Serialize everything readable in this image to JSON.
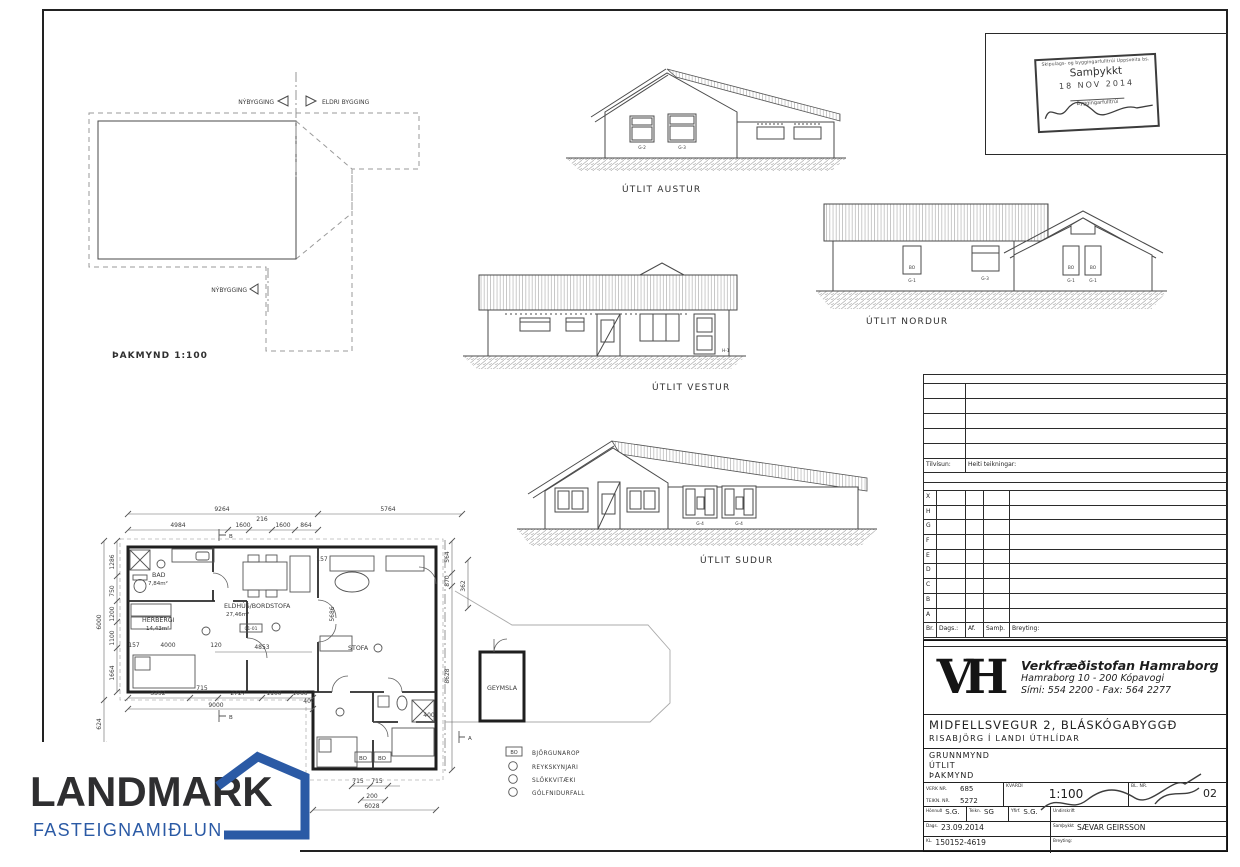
{
  "page": {
    "bg": "#ffffff",
    "line_color": "#3c3c3c",
    "accent_blue": "#2b5aa5"
  },
  "stamp": {
    "line1": "Skipulags- og byggingarfulltrúi Uppsveita bs.",
    "line2": "Samþykkt",
    "date": "18 NOV 2014",
    "line4": "Byggingarfulltrúi"
  },
  "roof_plan": {
    "title": "ÞAKMYND 1:100",
    "new_label": "NÝBYGGING",
    "old_label": "ELDRI BYGGING",
    "new_label2": "NÝBYGGING"
  },
  "elevations": {
    "east": "ÚTLIT AUSTUR",
    "west": "ÚTLIT VESTUR",
    "north": "ÚTLIT NORDUR",
    "south": "ÚTLIT SUDUR",
    "tags": {
      "g1": "G-1",
      "g2": "G-2",
      "g3": "G-3",
      "g4": "G-4",
      "bo": "BO",
      "h1": "H-1"
    }
  },
  "floor_plan": {
    "rooms": {
      "bad": "BAD",
      "bad_area": "7,84m²",
      "herbergi": "HERBERGI",
      "herbergi_area": "14,43m²",
      "eldhus": "ELDHÚS/BORDSTOFA",
      "eldhus_area": "27,46m²",
      "stofa": "STOFA",
      "geymsla": "GEYMSLA"
    },
    "ref": "01-01",
    "bo": "BO",
    "sections": {
      "a": "A",
      "b": "B"
    },
    "dims": {
      "d9264": "9264",
      "d5764": "5764",
      "d4984": "4984",
      "d1600": "1600",
      "d216": "216",
      "d864": "864",
      "d6000": "6000",
      "d1286": "1286",
      "d750": "750",
      "d1200": "1200",
      "d1100": "1100",
      "d1664": "1664",
      "d624": "624",
      "d3392": "3392",
      "d715": "715",
      "d2727": "2727",
      "d1066": "1066",
      "d9000": "9000",
      "d200": "200",
      "d6028": "6028",
      "d8628": "8628",
      "d870": "870",
      "d362": "362",
      "d564": "564",
      "d5686": "5686",
      "d4853": "4853",
      "d4000": "4000",
      "d120": "120",
      "d157": "157",
      "d400": "400"
    }
  },
  "legend": {
    "items": [
      {
        "sym": "BO",
        "label": "BJÖRGUNAROP"
      },
      {
        "sym": "",
        "label": "REYKSKYNJARI"
      },
      {
        "sym": "",
        "label": "SLÖKKVITÆKI"
      },
      {
        "sym": "",
        "label": "GÓLFNIDURFALL"
      }
    ]
  },
  "rev_table": {
    "tilvisun": "Tilvísun:",
    "heiti": "Heiti teikningar:",
    "letters": [
      "X",
      "H",
      "G",
      "F",
      "E",
      "D",
      "C",
      "B",
      "A"
    ],
    "footer": {
      "br": "Br.",
      "dags": "Dags.:",
      "af": "Af.",
      "samth": "Samþ.",
      "breyting": "Breyting:"
    }
  },
  "title_block": {
    "vh": "VH",
    "company": "Verkfræðistofan Hamraborg",
    "address": "Hamraborg 10  -  200 Kópavogi",
    "phone": "Sími: 554 2200 - Fax: 564 2277",
    "project": "MIDFELLSVEGUR 2, BLÁSKÓGABYGGÐ",
    "project2": "RISABJÖRG Í LANDI ÚTHLÍDAR",
    "c1": "GRUNNMYND",
    "c2": "ÚTLIT",
    "c3": "ÞAKMYND",
    "verk_label": "VERK NR.",
    "verk": "685",
    "teikn_label": "TEIKN. NR.",
    "teikn": "5272",
    "kvardi_label": "KVARDI",
    "kvardi": "1:100",
    "bl_label": "BL. NR.",
    "bl": "02",
    "hann_label": "Hönnuð",
    "hann": "S.G.",
    "tk_label": "Teikn.",
    "tk": "SG",
    "yf_label": "Yfirf.",
    "yf": "S.G.",
    "undir_label": "Undirskrift",
    "dags_label": "Dags.",
    "dags": "23.09.2014",
    "samth_label": "Samþykkt",
    "samth": "SÆVAR GEIRSSON",
    "kl_label": "KL.",
    "kl": "150152-4619",
    "brey_label": "Breyting:"
  },
  "landmark": {
    "name": "LANDMARK",
    "tagline": "FASTEIGNAMIÐLUN"
  }
}
